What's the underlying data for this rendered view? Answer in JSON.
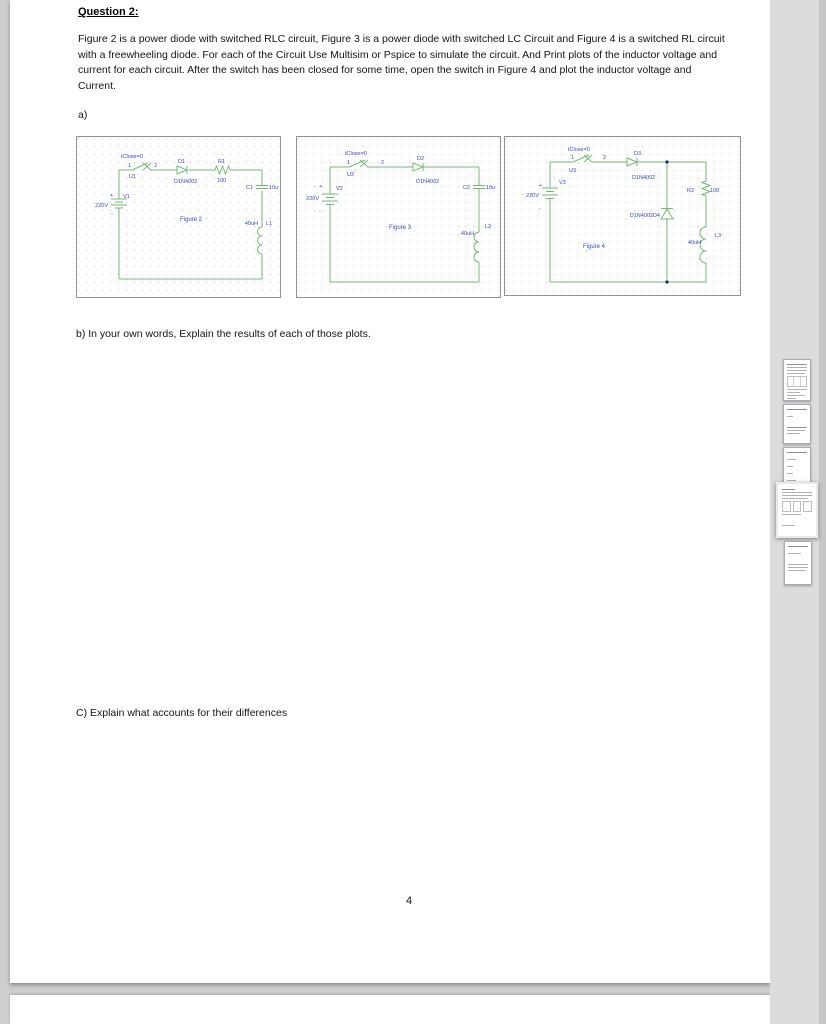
{
  "colors": {
    "canvas_bg": "#cdced0",
    "page_bg": "#ffffff",
    "rail_bg": "#dbdcdd",
    "wire_green": "#74b874",
    "label_blue": "#3b46c8",
    "grid_dot": "#c6cad2",
    "node_navy": "#1c2b66"
  },
  "document": {
    "title": "Question 2:",
    "paragraph": "Figure 2 is a power diode with switched RLC circuit, Figure 3 is a power diode with switched LC Circuit and Figure 4 is a switched RL circuit with a freewheeling diode. For each of the Circuit Use Multisim or Pspice to simulate the circuit. And Print plots of the inductor voltage and current for each circuit. After the switch has been closed for some time, open the switch in Figure 4 and plot the inductor voltage and Current.",
    "part_a": "a)",
    "part_b": "b) In your own words, Explain the results of each of those plots.",
    "part_c": "C) Explain what accounts for their differences",
    "page_number": "4"
  },
  "sidebar": {
    "thumbnail_count": 5,
    "current_thumbnail": 4
  },
  "circuits": [
    {
      "caption": "Figure 2",
      "labels": {
        "tclose": "tClose=0",
        "t1": "1",
        "t2": "2",
        "sw": "U1",
        "d": "D1",
        "dmodel": "D1N4002",
        "r": "R1",
        "rval": "100",
        "c": "C1",
        "cval": "10u",
        "v": "V1",
        "vval": "220V",
        "plus": "+",
        "minus": "-",
        "lval": "40uH",
        "l": "L1"
      }
    },
    {
      "caption": "Figure 3",
      "labels": {
        "tclose": "tClose=0",
        "t1": "1",
        "t2": "2",
        "sw": "U2",
        "d": "D2",
        "dmodel": "D1N4002",
        "c": "C2",
        "cval": "10u",
        "v": "V2",
        "vval": "220V",
        "plus": "+",
        "minus": "-",
        "lval": "40uH",
        "l": "L2"
      }
    },
    {
      "caption": "Figure 4",
      "labels": {
        "tclose": "tClose=0",
        "t1": "1",
        "t2": "2",
        "sw": "U3",
        "d": "D3",
        "dmodel": "D1N4002",
        "fw": "D1N4002D4",
        "r": "R2",
        "rval": "100",
        "v": "V3",
        "vval": "220V",
        "plus": "+",
        "minus": "-",
        "lval": "40uH",
        "l": "L3"
      }
    }
  ]
}
